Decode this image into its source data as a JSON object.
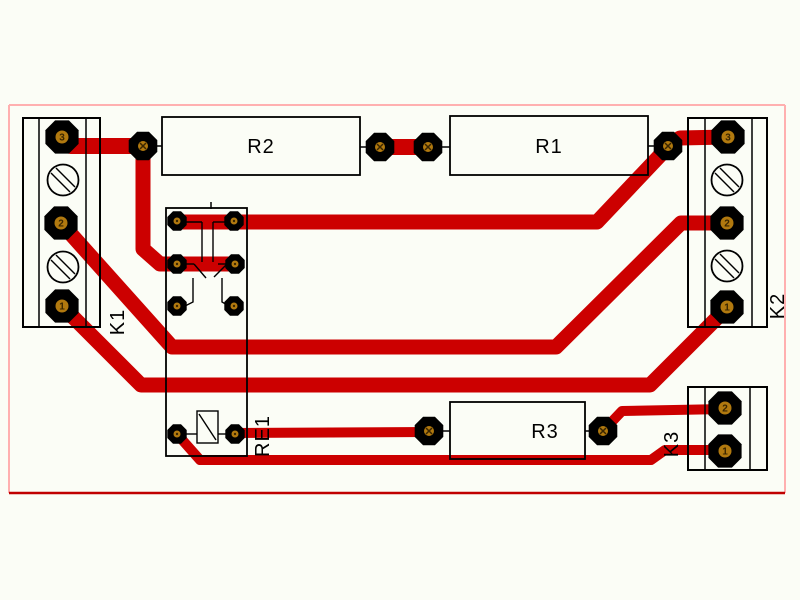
{
  "board": {
    "view": "pcb-layout-top-copper",
    "labels": {
      "k1": "K1",
      "k2": "K2",
      "k3": "K3",
      "re1": "RE1",
      "r1": "R1",
      "r2": "R2",
      "r3": "R3"
    },
    "pins": {
      "k1": [
        "3",
        "2",
        "1"
      ],
      "k2": [
        "3",
        "2",
        "1"
      ],
      "k3": [
        "2",
        "1"
      ]
    },
    "colors": {
      "copper_trace": "#cc0000",
      "board_outline_pink": "#ffb0b0",
      "board_outline_bottom": "#c00000",
      "silkscreen": "#000000",
      "pad_black": "#000000",
      "drill_orange": "#b1790f",
      "background": "#fbfdf6"
    }
  }
}
